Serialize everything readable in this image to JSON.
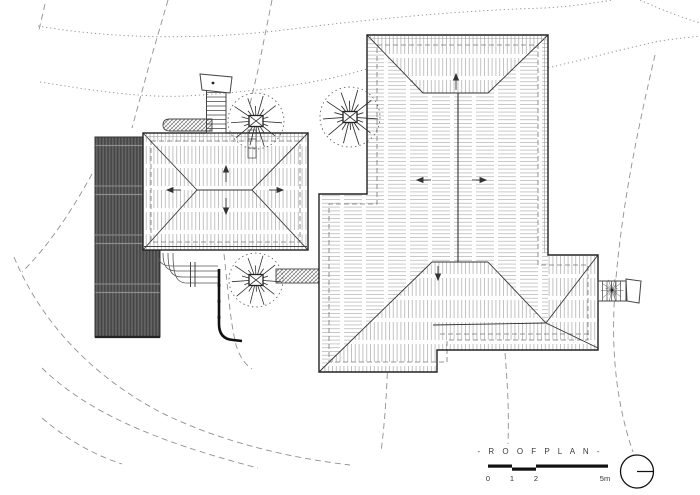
{
  "drawing": {
    "title": "- R O O F   P L A N -"
  },
  "scale_bar": {
    "labels": [
      "0",
      "1",
      "2",
      "5m"
    ]
  },
  "north_arrow": {
    "icon": "north-arrow"
  },
  "colors": {
    "paper": "#ffffff",
    "ink": "#1a1a1a",
    "roof_hatch": "#b3b3b3",
    "dark_roof": "#565656",
    "site_line": "#8a8a8a"
  }
}
